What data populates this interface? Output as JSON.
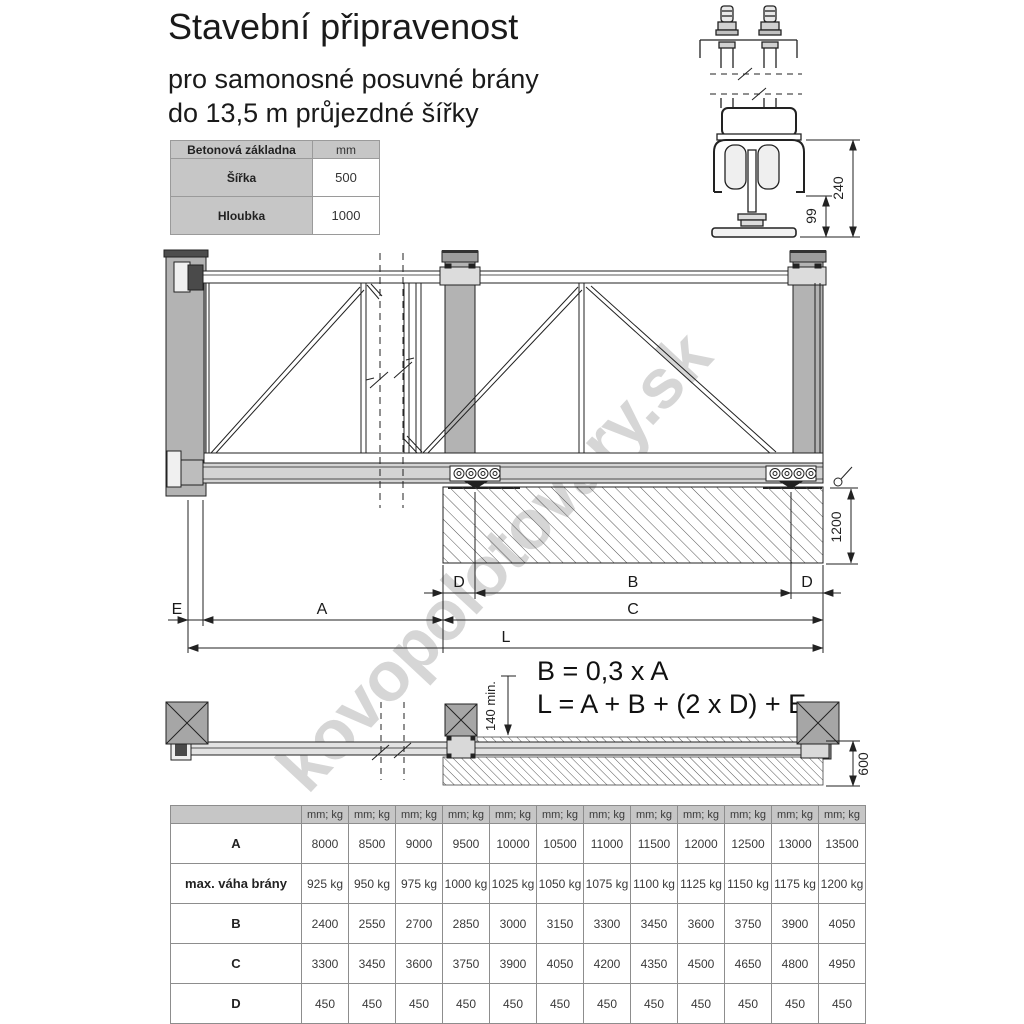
{
  "title": "Stavební připravenost",
  "subtitle_line1": "pro samonosné posuvné brány",
  "subtitle_line2": "do 13,5 m průjezdné šířky",
  "foundation_table": {
    "header_label": "Betonová základna",
    "header_unit": "mm",
    "rows": [
      {
        "label": "Šířka",
        "value": "500"
      },
      {
        "label": "Hloubka",
        "value": "1000"
      }
    ]
  },
  "formulas": {
    "formula_b": "B = 0,3 x A",
    "formula_l": "L = A + B + (2 x D) + E"
  },
  "dimensions": {
    "detail_height": "240",
    "detail_carriage_height": "99",
    "foundation_depth": "1200",
    "clearance_min": "140 min.",
    "side_foundation_width": "600",
    "dim_d_left": "D",
    "dim_b": "B",
    "dim_d_right": "D",
    "dim_e": "E",
    "dim_a": "A",
    "dim_c": "C",
    "dim_l": "L"
  },
  "watermark": "kovopolotovary.sk",
  "spec_table": {
    "unit_header": "mm; kg",
    "rows": [
      {
        "label": "A",
        "values": [
          "8000",
          "8500",
          "9000",
          "9500",
          "10000",
          "10500",
          "11000",
          "11500",
          "12000",
          "12500",
          "13000",
          "13500"
        ]
      },
      {
        "label": "max. váha brány",
        "values": [
          "925 kg",
          "950 kg",
          "975 kg",
          "1000 kg",
          "1025 kg",
          "1050 kg",
          "1075 kg",
          "1100 kg",
          "1125 kg",
          "1150 kg",
          "1175 kg",
          "1200 kg"
        ]
      },
      {
        "label": "B",
        "values": [
          "2400",
          "2550",
          "2700",
          "2850",
          "3000",
          "3150",
          "3300",
          "3450",
          "3600",
          "3750",
          "3900",
          "4050"
        ]
      },
      {
        "label": "C",
        "values": [
          "3300",
          "3450",
          "3600",
          "3750",
          "3900",
          "4050",
          "4200",
          "4350",
          "4500",
          "4650",
          "4800",
          "4950"
        ]
      },
      {
        "label": "D",
        "values": [
          "450",
          "450",
          "450",
          "450",
          "450",
          "450",
          "450",
          "450",
          "450",
          "450",
          "450",
          "450"
        ]
      }
    ]
  },
  "colors": {
    "post_gray": "#b3b3b3",
    "cap_gray": "#8c8c8c",
    "table_gray": "#c6c6c6",
    "line": "#222222",
    "watermark_gray": "#bcbcbc"
  }
}
